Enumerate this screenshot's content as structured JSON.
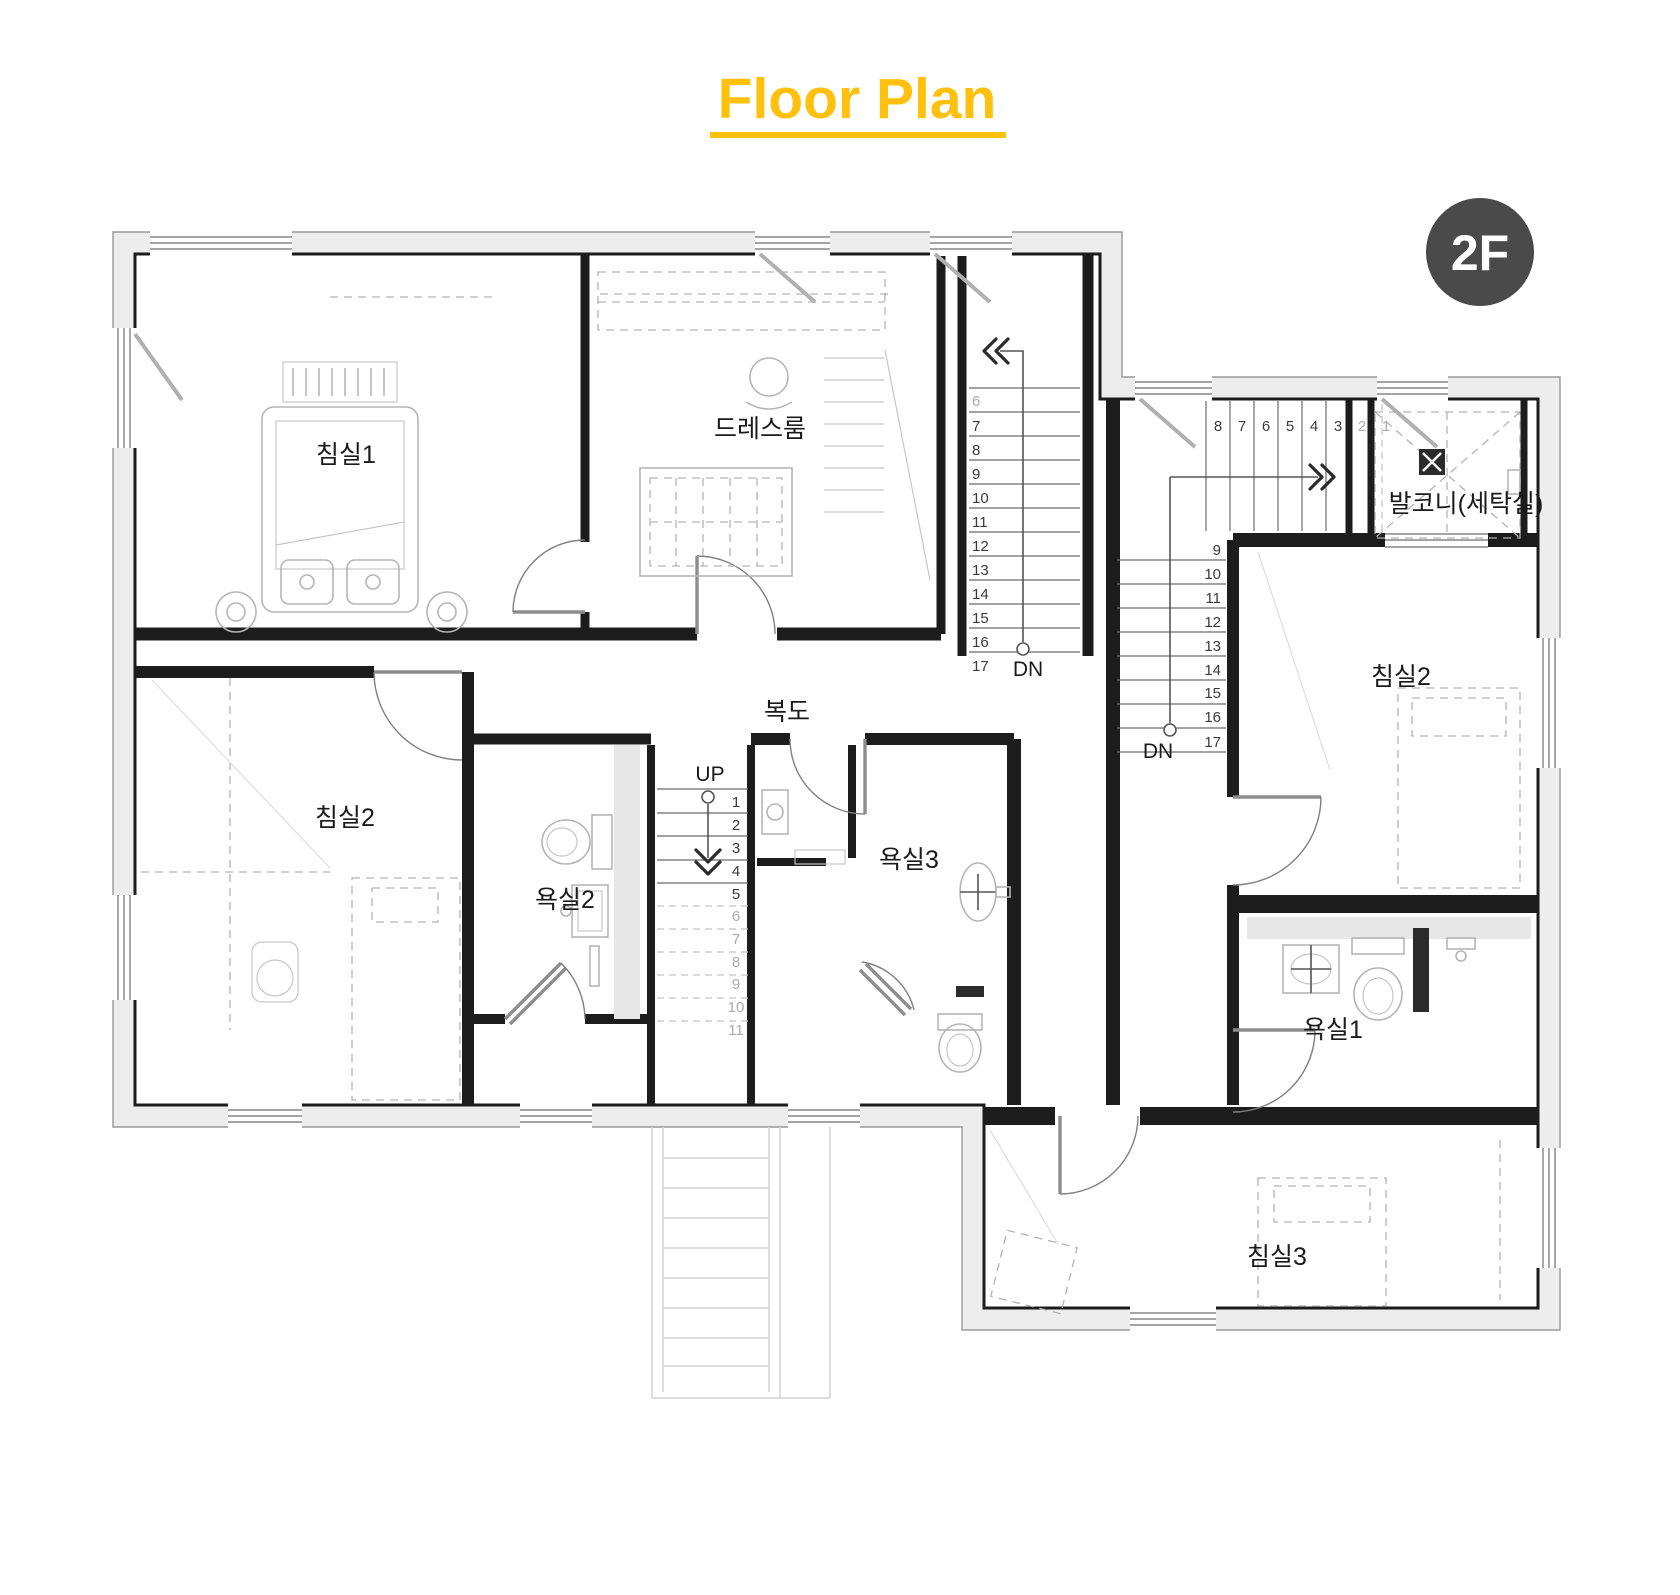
{
  "title": {
    "text": "Floor Plan",
    "color": "#FFC10D"
  },
  "floor_badge": {
    "text": "2F",
    "bg": "#4A4A4A",
    "fg": "#FFFFFF"
  },
  "rooms": {
    "bedroom1": "침실1",
    "dressroom": "드레스룸",
    "corridor": "복도",
    "bedroom2_left": "침실2",
    "bath2": "욕실2",
    "bath3": "욕실3",
    "balcony": "발코니(세탁실)",
    "bedroom2_right": "침실2",
    "bath1": "욕실1",
    "bedroom3": "침실3"
  },
  "stairs": [
    {
      "name": "stair_main",
      "label": "DN",
      "label_x": 1028,
      "label_y": 676,
      "anchor": "start",
      "items": [
        {
          "t": "6",
          "x": 972,
          "y": 406,
          "gray": true
        },
        {
          "t": "7",
          "x": 972,
          "y": 431
        },
        {
          "t": "8",
          "x": 972,
          "y": 455
        },
        {
          "t": "9",
          "x": 972,
          "y": 479
        },
        {
          "t": "10",
          "x": 972,
          "y": 503
        },
        {
          "t": "11",
          "x": 972,
          "y": 527
        },
        {
          "t": "12",
          "x": 972,
          "y": 551
        },
        {
          "t": "13",
          "x": 972,
          "y": 575
        },
        {
          "t": "14",
          "x": 972,
          "y": 599
        },
        {
          "t": "15",
          "x": 972,
          "y": 623
        },
        {
          "t": "16",
          "x": 972,
          "y": 647
        },
        {
          "t": "17",
          "x": 972,
          "y": 671
        }
      ]
    },
    {
      "name": "stair_up",
      "label": "UP",
      "label_x": 710,
      "label_y": 781,
      "anchor": "middle",
      "items": [
        {
          "t": "1",
          "x": 736,
          "y": 807
        },
        {
          "t": "2",
          "x": 736,
          "y": 830
        },
        {
          "t": "3",
          "x": 736,
          "y": 853
        },
        {
          "t": "4",
          "x": 736,
          "y": 876
        },
        {
          "t": "5",
          "x": 736,
          "y": 899
        },
        {
          "t": "6",
          "x": 736,
          "y": 921,
          "gray": true
        },
        {
          "t": "7",
          "x": 736,
          "y": 944,
          "gray": true
        },
        {
          "t": "8",
          "x": 736,
          "y": 967,
          "gray": true
        },
        {
          "t": "9",
          "x": 736,
          "y": 989,
          "gray": true
        },
        {
          "t": "10",
          "x": 736,
          "y": 1012,
          "gray": true
        },
        {
          "t": "11",
          "x": 736,
          "y": 1035,
          "gray": true
        }
      ]
    },
    {
      "name": "stair_right_horizontal",
      "label": "",
      "label_x": 0,
      "label_y": 0,
      "anchor": "middle",
      "items": [
        {
          "t": "8",
          "x": 1218,
          "y": 431
        },
        {
          "t": "7",
          "x": 1242,
          "y": 431
        },
        {
          "t": "6",
          "x": 1266,
          "y": 431
        },
        {
          "t": "5",
          "x": 1290,
          "y": 431
        },
        {
          "t": "4",
          "x": 1314,
          "y": 431
        },
        {
          "t": "3",
          "x": 1338,
          "y": 431
        },
        {
          "t": "2",
          "x": 1362,
          "y": 431,
          "gray": true
        },
        {
          "t": "1",
          "x": 1386,
          "y": 431,
          "gray": true
        }
      ]
    },
    {
      "name": "stair_right_vertical",
      "label": "DN",
      "label_x": 1158,
      "label_y": 758,
      "anchor": "end",
      "items": [
        {
          "t": "9",
          "x": 1221,
          "y": 555
        },
        {
          "t": "10",
          "x": 1221,
          "y": 579
        },
        {
          "t": "11",
          "x": 1221,
          "y": 603
        },
        {
          "t": "12",
          "x": 1221,
          "y": 627
        },
        {
          "t": "13",
          "x": 1221,
          "y": 651
        },
        {
          "t": "14",
          "x": 1221,
          "y": 675
        },
        {
          "t": "15",
          "x": 1221,
          "y": 698
        },
        {
          "t": "16",
          "x": 1221,
          "y": 722
        },
        {
          "t": "17",
          "x": 1221,
          "y": 747
        }
      ]
    }
  ]
}
